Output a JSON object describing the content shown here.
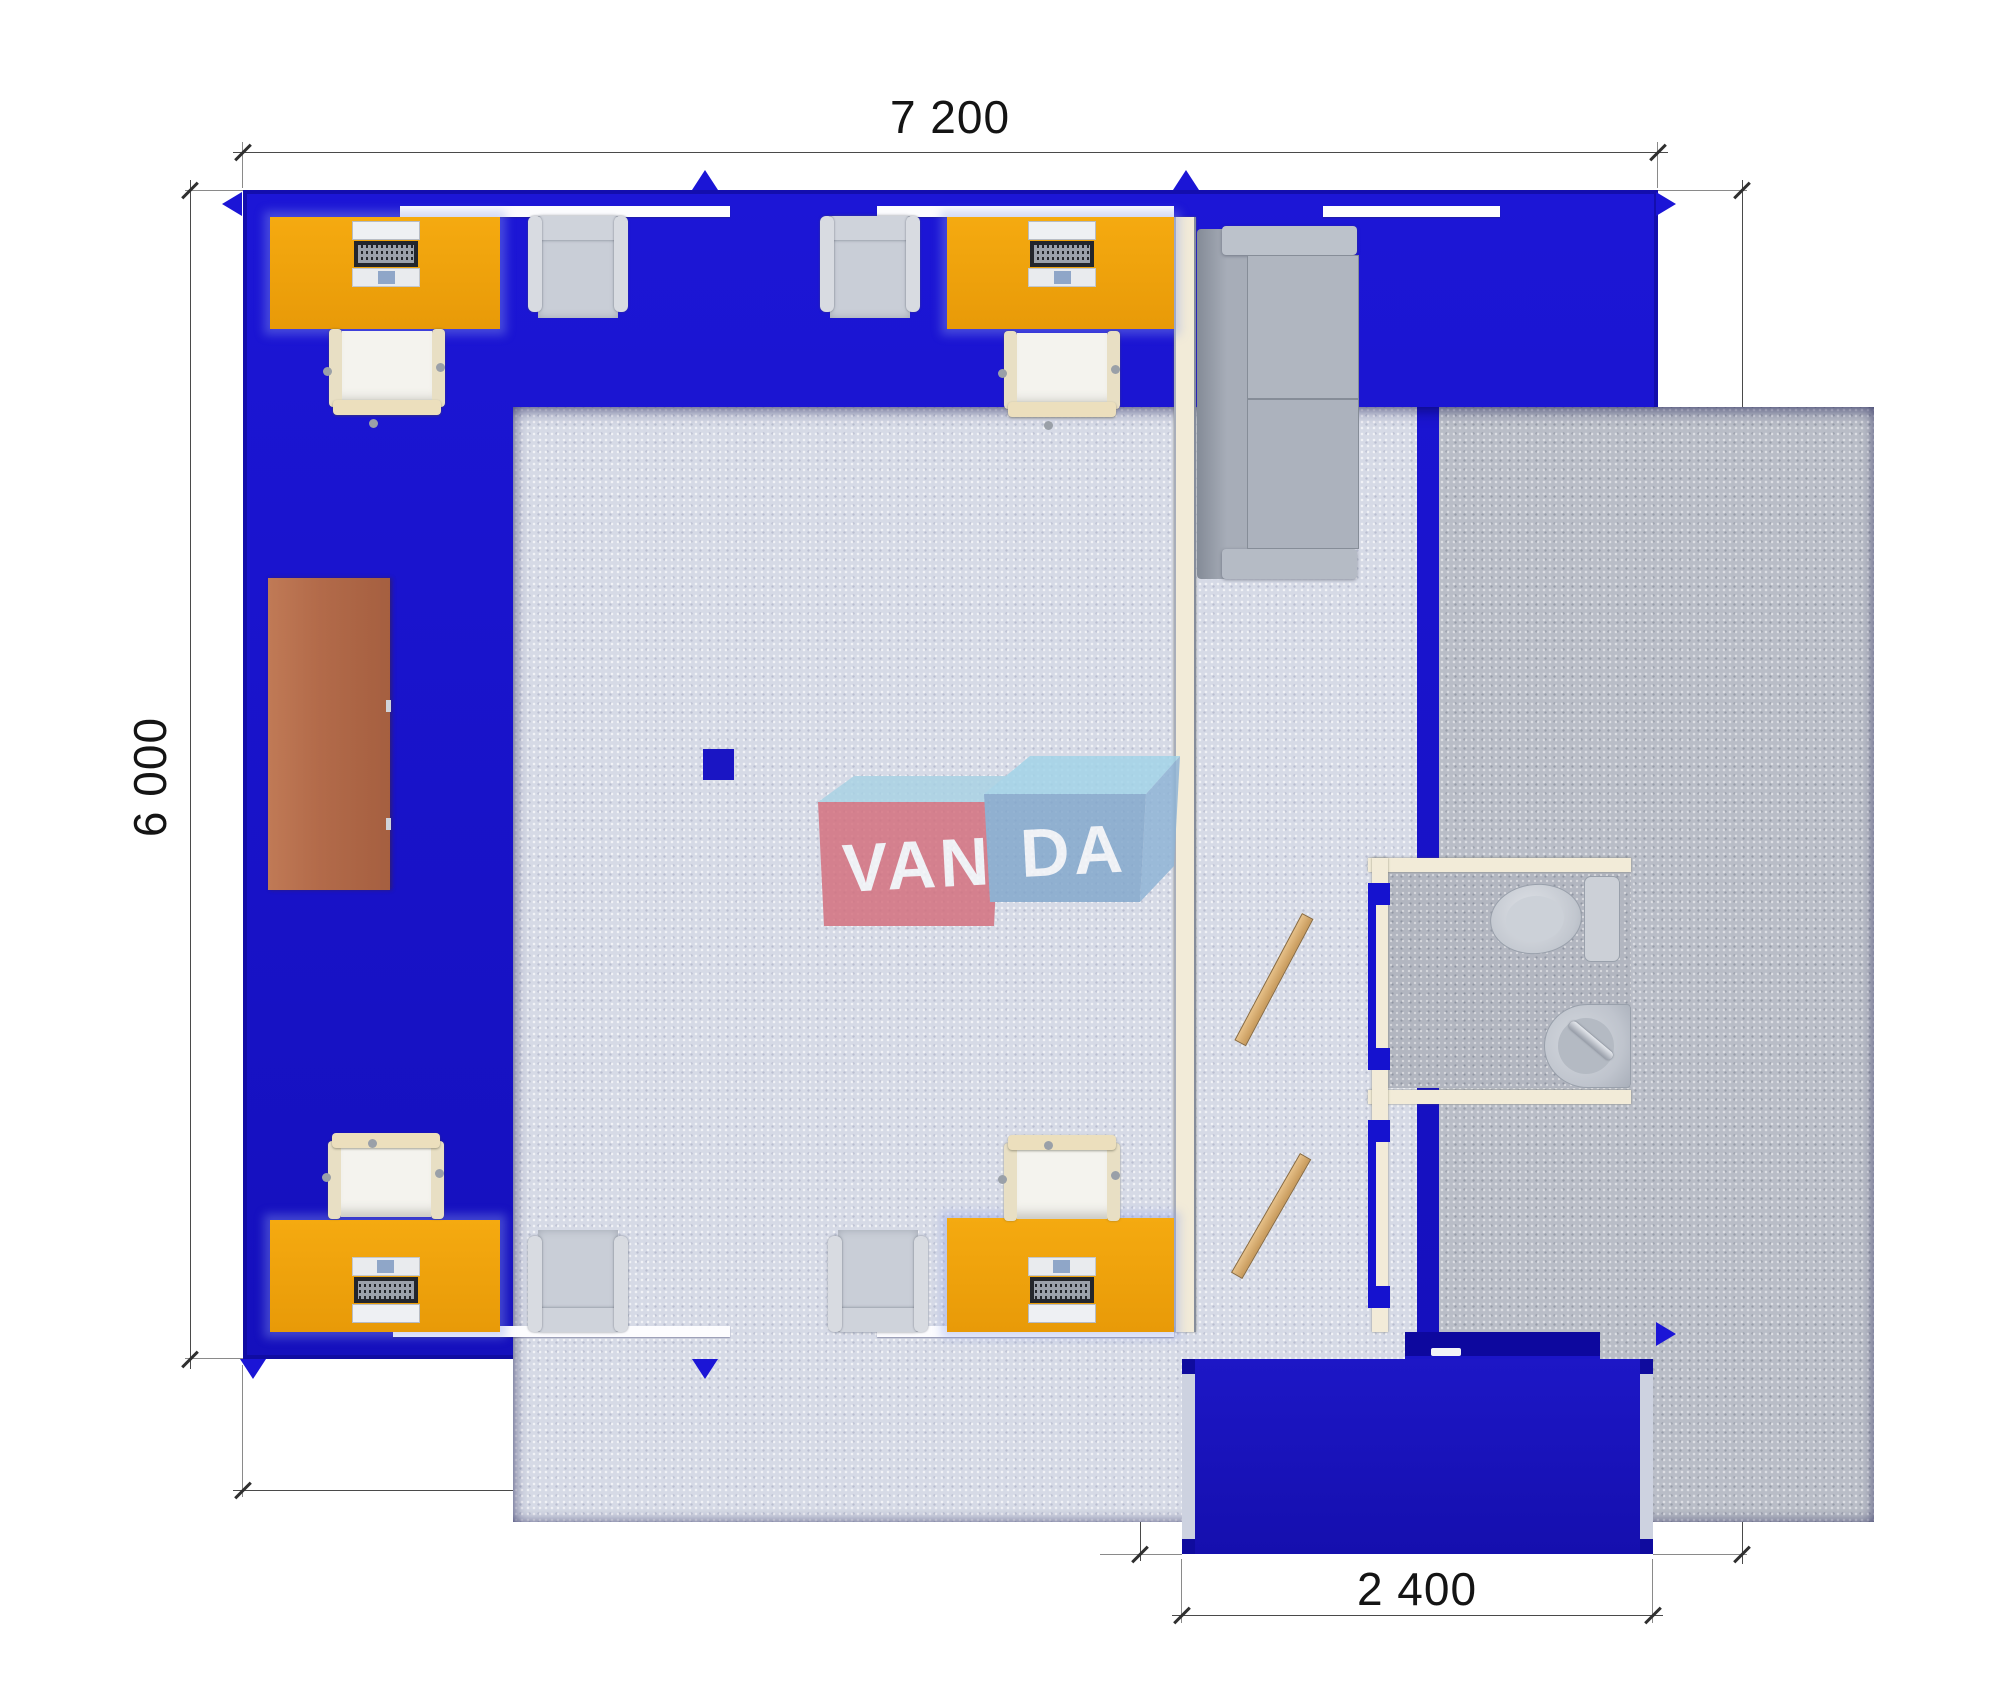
{
  "scene": {
    "type": "architectural floor plan (top view render)",
    "units": "mm"
  },
  "dimensions": {
    "top": "7 200",
    "left": "6 000",
    "right": "6 000",
    "bottom_left": "4 800",
    "porch_left": "1 000",
    "porch_right": "1 000",
    "porch_bottom": "2 400"
  },
  "logo": {
    "left_block": "VAN",
    "right_block": "DA"
  },
  "colors": {
    "wall_blue": "#1711cb",
    "porch_blue": "#1a14b8",
    "desk_orange": "#efa30d",
    "sideboard_brown": "#b36b4a",
    "partition_cream": "#f2ebd8",
    "floor_office": "#d6dae6",
    "floor_utility": "#b9bdc7",
    "door_wood": "#d6ab6e",
    "logo_red": "#d4707e",
    "logo_blue": "#83a8cc",
    "logo_top_face": "#a9d2e4",
    "lamp_blue": "#1a15c4"
  },
  "furniture": {
    "desks": 4,
    "desk_chairs": 4,
    "guest_armchairs": 4,
    "sofa": 1,
    "sideboard": 1,
    "toilet": 1,
    "sink": 1,
    "interior_doors": 2,
    "ceiling_lamp": 1
  }
}
